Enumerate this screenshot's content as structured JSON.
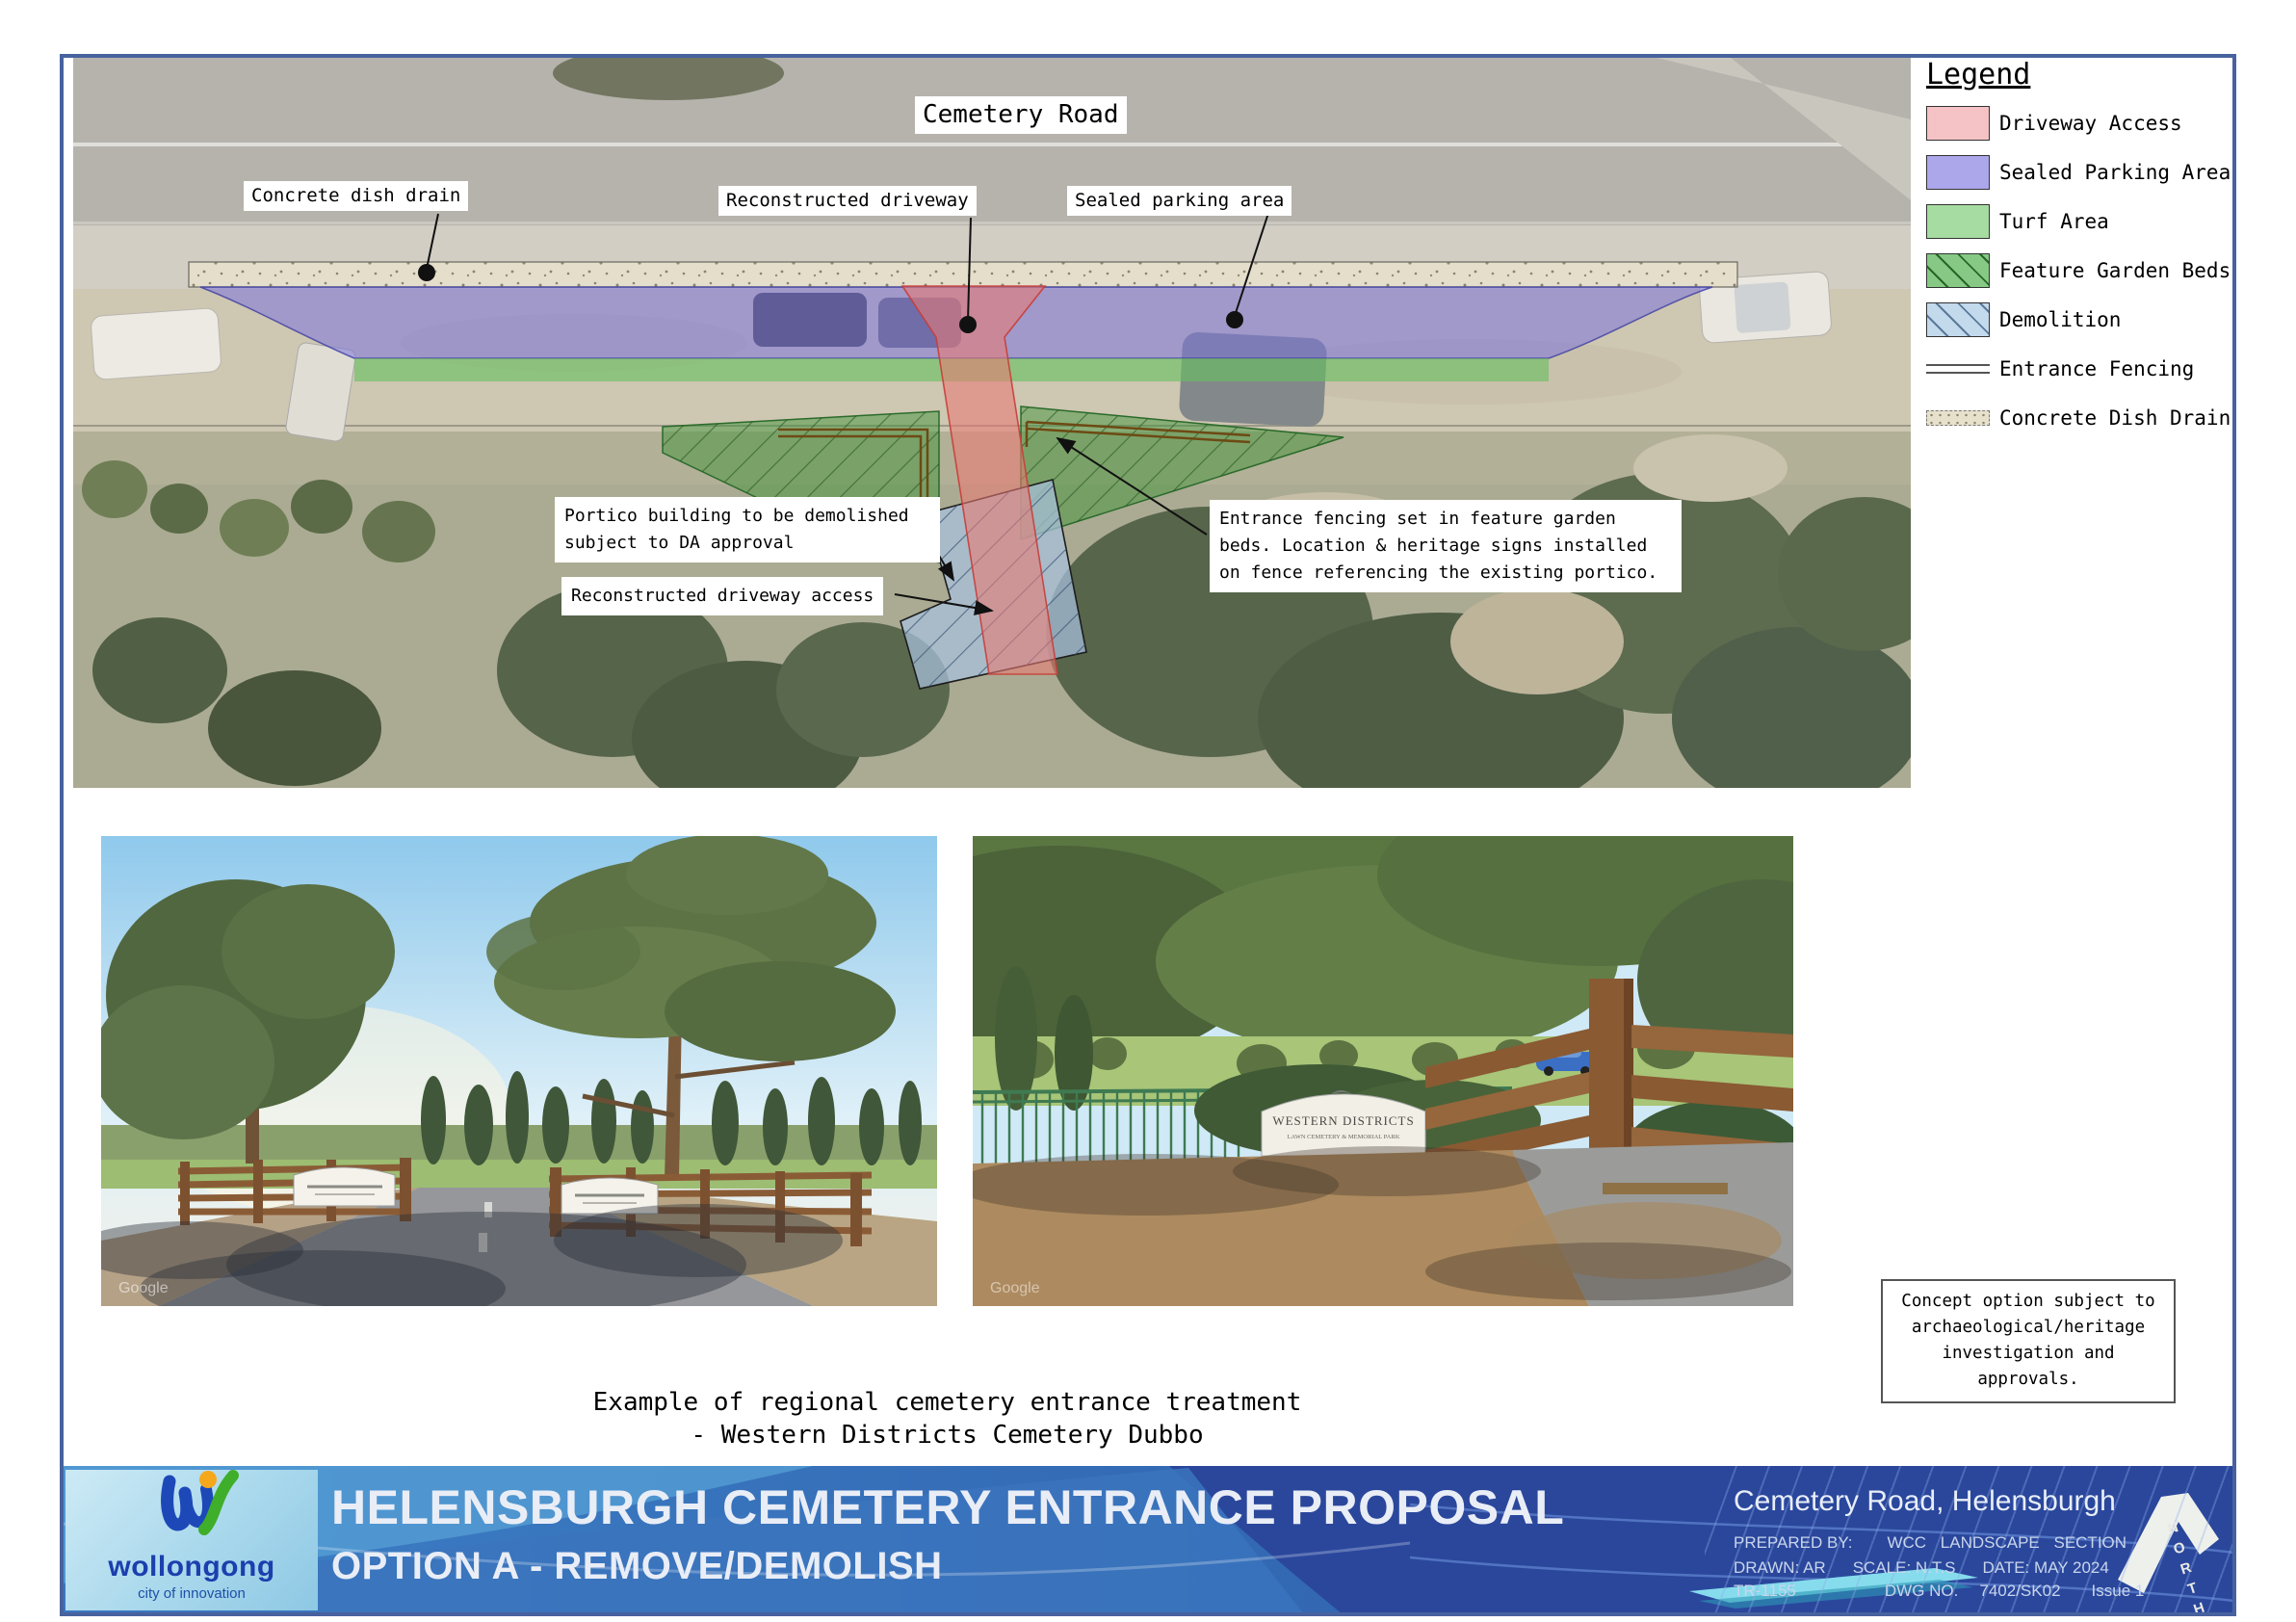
{
  "legend": {
    "title": "Legend",
    "items": [
      {
        "label": "Driveway Access",
        "swatch": "pink",
        "color": "#f5c2c5"
      },
      {
        "label": "Sealed Parking Area",
        "swatch": "purple",
        "color": "#aca7ea"
      },
      {
        "label": "Turf Area",
        "swatch": "green",
        "color": "#a6dca1"
      },
      {
        "label": "Feature Garden Beds",
        "swatch": "green-hatch",
        "color": "#85c985"
      },
      {
        "label": "Demolition",
        "swatch": "blue-hatch",
        "color": "#c3d9ec"
      },
      {
        "label": "Entrance Fencing",
        "swatch": "fence-lines"
      },
      {
        "label": "Concrete Dish Drain",
        "swatch": "drain-stipple",
        "color": "#e7e1cc"
      }
    ]
  },
  "plan": {
    "road_label": "Cemetery Road",
    "labels": {
      "drain": "Concrete dish drain",
      "driveway": "Reconstructed driveway",
      "parking": "Sealed parking area"
    },
    "annotations": {
      "portico": "Portico building to be demolished subject to DA approval",
      "access": "Reconstructed driveway access",
      "fencing": "Entrance fencing set in feature garden beds. Location & heritage signs installed on fence referencing the existing portico."
    }
  },
  "photos": {
    "caption_line1": "Example of regional cemetery entrance treatment",
    "caption_line2": "- Western Districts Cemetery Dubbo",
    "sign_title": "WESTERN DISTRICTS",
    "sign_subtitle": "LAWN CEMETERY & MEMORIAL PARK",
    "watermark": "Google"
  },
  "note": {
    "line1": "Concept option subject to",
    "line2": "archaeological/heritage",
    "line3": "investigation and approvals."
  },
  "footer": {
    "title": "HELENSBURGH CEMETERY ENTRANCE PROPOSAL",
    "subtitle": "OPTION A - REMOVE/DEMOLISH",
    "logo_name": "wollongong",
    "logo_tagline": "city of innovation",
    "location": "Cemetery Road, Helensburgh",
    "prepared_label": "PREPARED BY:",
    "prepared_value": "WCC LANDSCAPE SECTION",
    "drawn": "DRAWN: AR",
    "scale": "SCALE: N.T.S",
    "date": "DATE: MAY 2024",
    "ref": "TR-1155",
    "dwg_label": "DWG NO.",
    "dwg_no": "7402/SK02",
    "issue": "Issue 1",
    "north_label": "NORTH"
  },
  "colors": {
    "page_border": "#47629e",
    "driveway_overlay": "#e87a74",
    "parking_overlay": "#7a70dc",
    "turf_overlay": "#68c060",
    "garden_overlay": "#42943a",
    "demolition_overlay": "#a8c1de",
    "footer_blue": "#3c80c6",
    "footer_navy": "#2a479c",
    "accent_cyan": "#86dcec"
  }
}
